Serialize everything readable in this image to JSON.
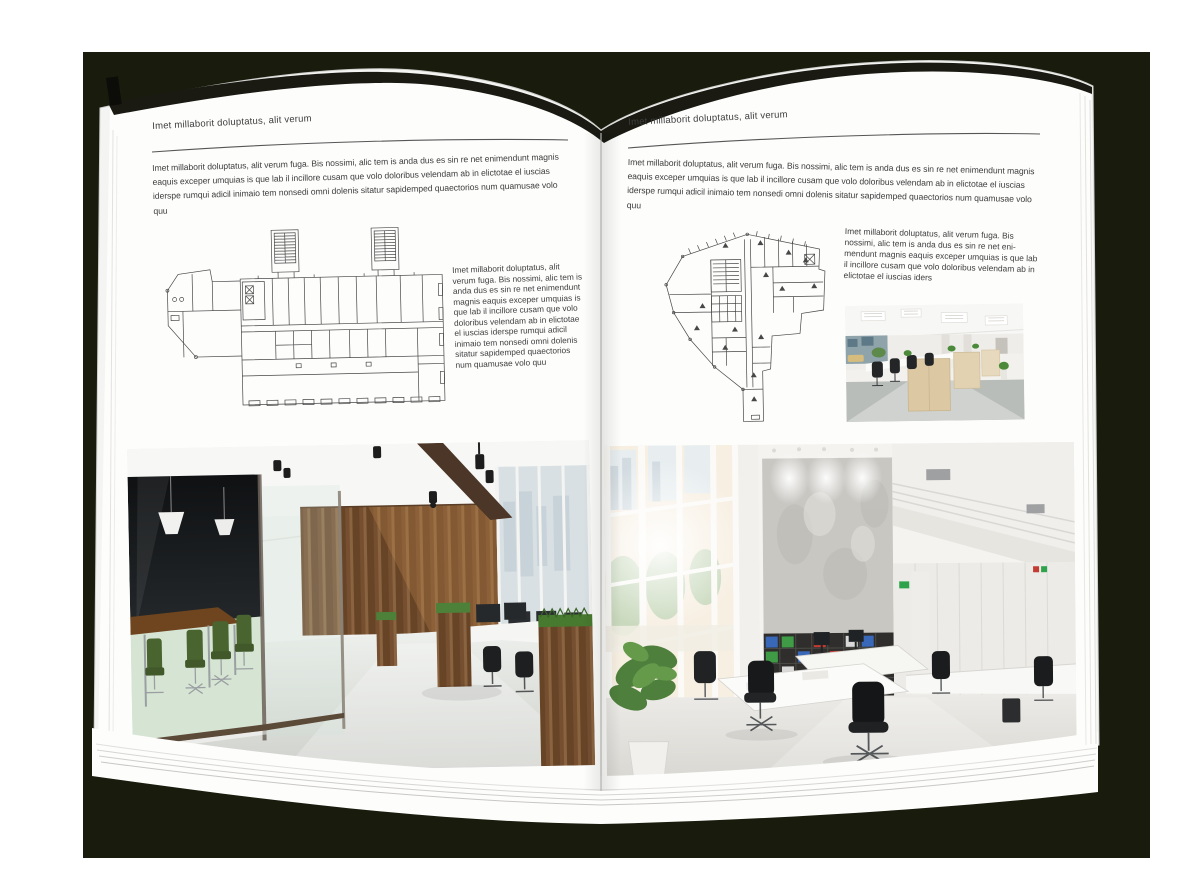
{
  "book": {
    "backdrop_color": "#191c0d",
    "page_color": "#fdfdfc",
    "text_color": "#3d3d3d",
    "plan_ink_color": "#474747"
  },
  "left_page": {
    "header": "Imet millaborit doluptatus, alit verum",
    "intro": "Imet millaborit doluptatus, alit verum fuga. Bis nossimi, alic tem is anda dus es sin re net enimendunt magnis eaquis exceper umquias is que lab il incillore cusam que volo doloribus velendam ab in elictotae el iuscias iderspe rumqui adicil inimaio tem nonsedi omni dolenis sitatur sapidemped quaectorios num quamusae volo quu",
    "side_text": "Imet millaborit doluptatus, alit verum fuga. Bis nossimi, alic tem is anda dus es sin re net enimendunt magnis eaquis exceper umquias is que lab il incillore cusam que volo doloribus velendam ab in elictotae el iuscias iderspe rumqui adicil inimaio tem nonsedi omni dolenis sitatur sapidemped quaectorios num quamusae volo quu",
    "floor_plan": "wide-office-building-floor-plan-with-two-stair-towers",
    "photo": "office-interior-glass-meeting-room-green-chairs-wood-wall"
  },
  "right_page": {
    "header": "Imet millaborit doluptatus, alit verum",
    "intro": "Imet millaborit doluptatus, alit verum fuga. Bis nossimi, alic tem is anda dus es sin re net enimendunt magnis eaquis exceper umquias is que lab il incillore cusam que volo doloribus velendam ab in elictotae el iuscias iderspe rumqui adicil inimaio tem nonsedi omni dolenis sitatur sapidemped quaectorios num quamusae volo quu",
    "side_text": "Imet millaborit doluptatus, alit verum fuga. Bis nossimi, alic tem is anda dus es sin re net eni-mendunt magnis eaquis exceper umquias is que lab il incillore cusam que volo doloribus velendam ab in elictotae el iuscias iders",
    "floor_plan": "irregular-wedge-floor-plan-with-corridor-spine",
    "photo_small": "open-plan-office-workstation-rows",
    "photo_large": "bright-double-height-office-atrium-bookshelves"
  }
}
